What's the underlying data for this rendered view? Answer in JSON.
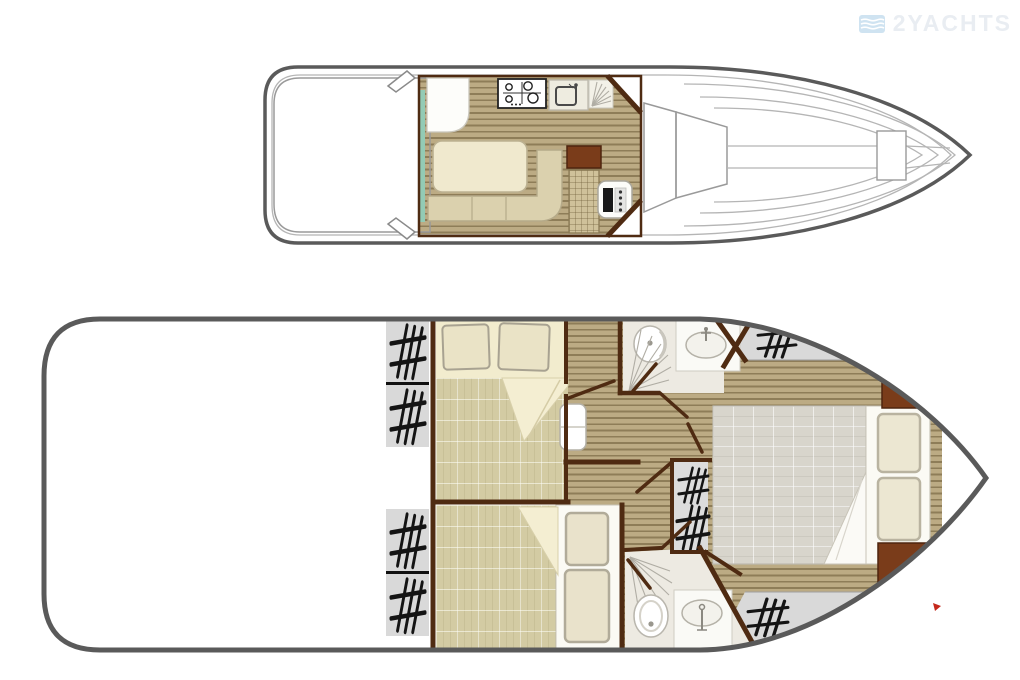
{
  "watermark": {
    "text": "2YACHTS",
    "icon": "waves-logo-icon"
  },
  "palette": {
    "hull_outline": "#5a5a5a",
    "wall_brown": "#4f2b12",
    "cabinet_brown": "#7a3c1a",
    "wood_light": "#bcab84",
    "wood_line": "#8e7d58",
    "carpet_beige": "#d3cba3",
    "bed_cream": "#f2ecce",
    "blanket_gray": "#d8d5cc",
    "hatch_gray": "#d9d9d9",
    "bath_floor": "#edeae2",
    "teal_accent": "#93cbb5",
    "marker_red": "#c4281c",
    "watermark_blue": "#cfe3f1",
    "watermark_text": "#e9edf2"
  },
  "upper_deck": {
    "name": "main-deck-plan",
    "features": [
      "aft-sun-deck",
      "mooring-cleats",
      "sliding-door-teal",
      "galley-counter",
      "stove-icon",
      "sink-icon",
      "dish-drainer-icon",
      "dinette-table",
      "l-shaped-bench",
      "helm-cabinet",
      "helm-seat",
      "helm-console",
      "cockpit-steps",
      "bow-walkway",
      "bow-hatch"
    ]
  },
  "lower_deck": {
    "name": "cabin-deck-plan",
    "features": [
      "boarding-steps-hatch-marks",
      "forward-double-cabin",
      "double-bed-pillows",
      "corridor",
      "step-box",
      "shower-room-forward",
      "toilet-icon",
      "washbasin-icon",
      "shower-rays-icon",
      "companionway-stairs",
      "aft-double-cabin",
      "single-bed-pillows",
      "shower-room-aft",
      "bow-double-cabin",
      "bow-bed-gray-blanket",
      "bow-steps-hatch-marks"
    ]
  },
  "marker": {
    "shape": "red-triangle"
  }
}
